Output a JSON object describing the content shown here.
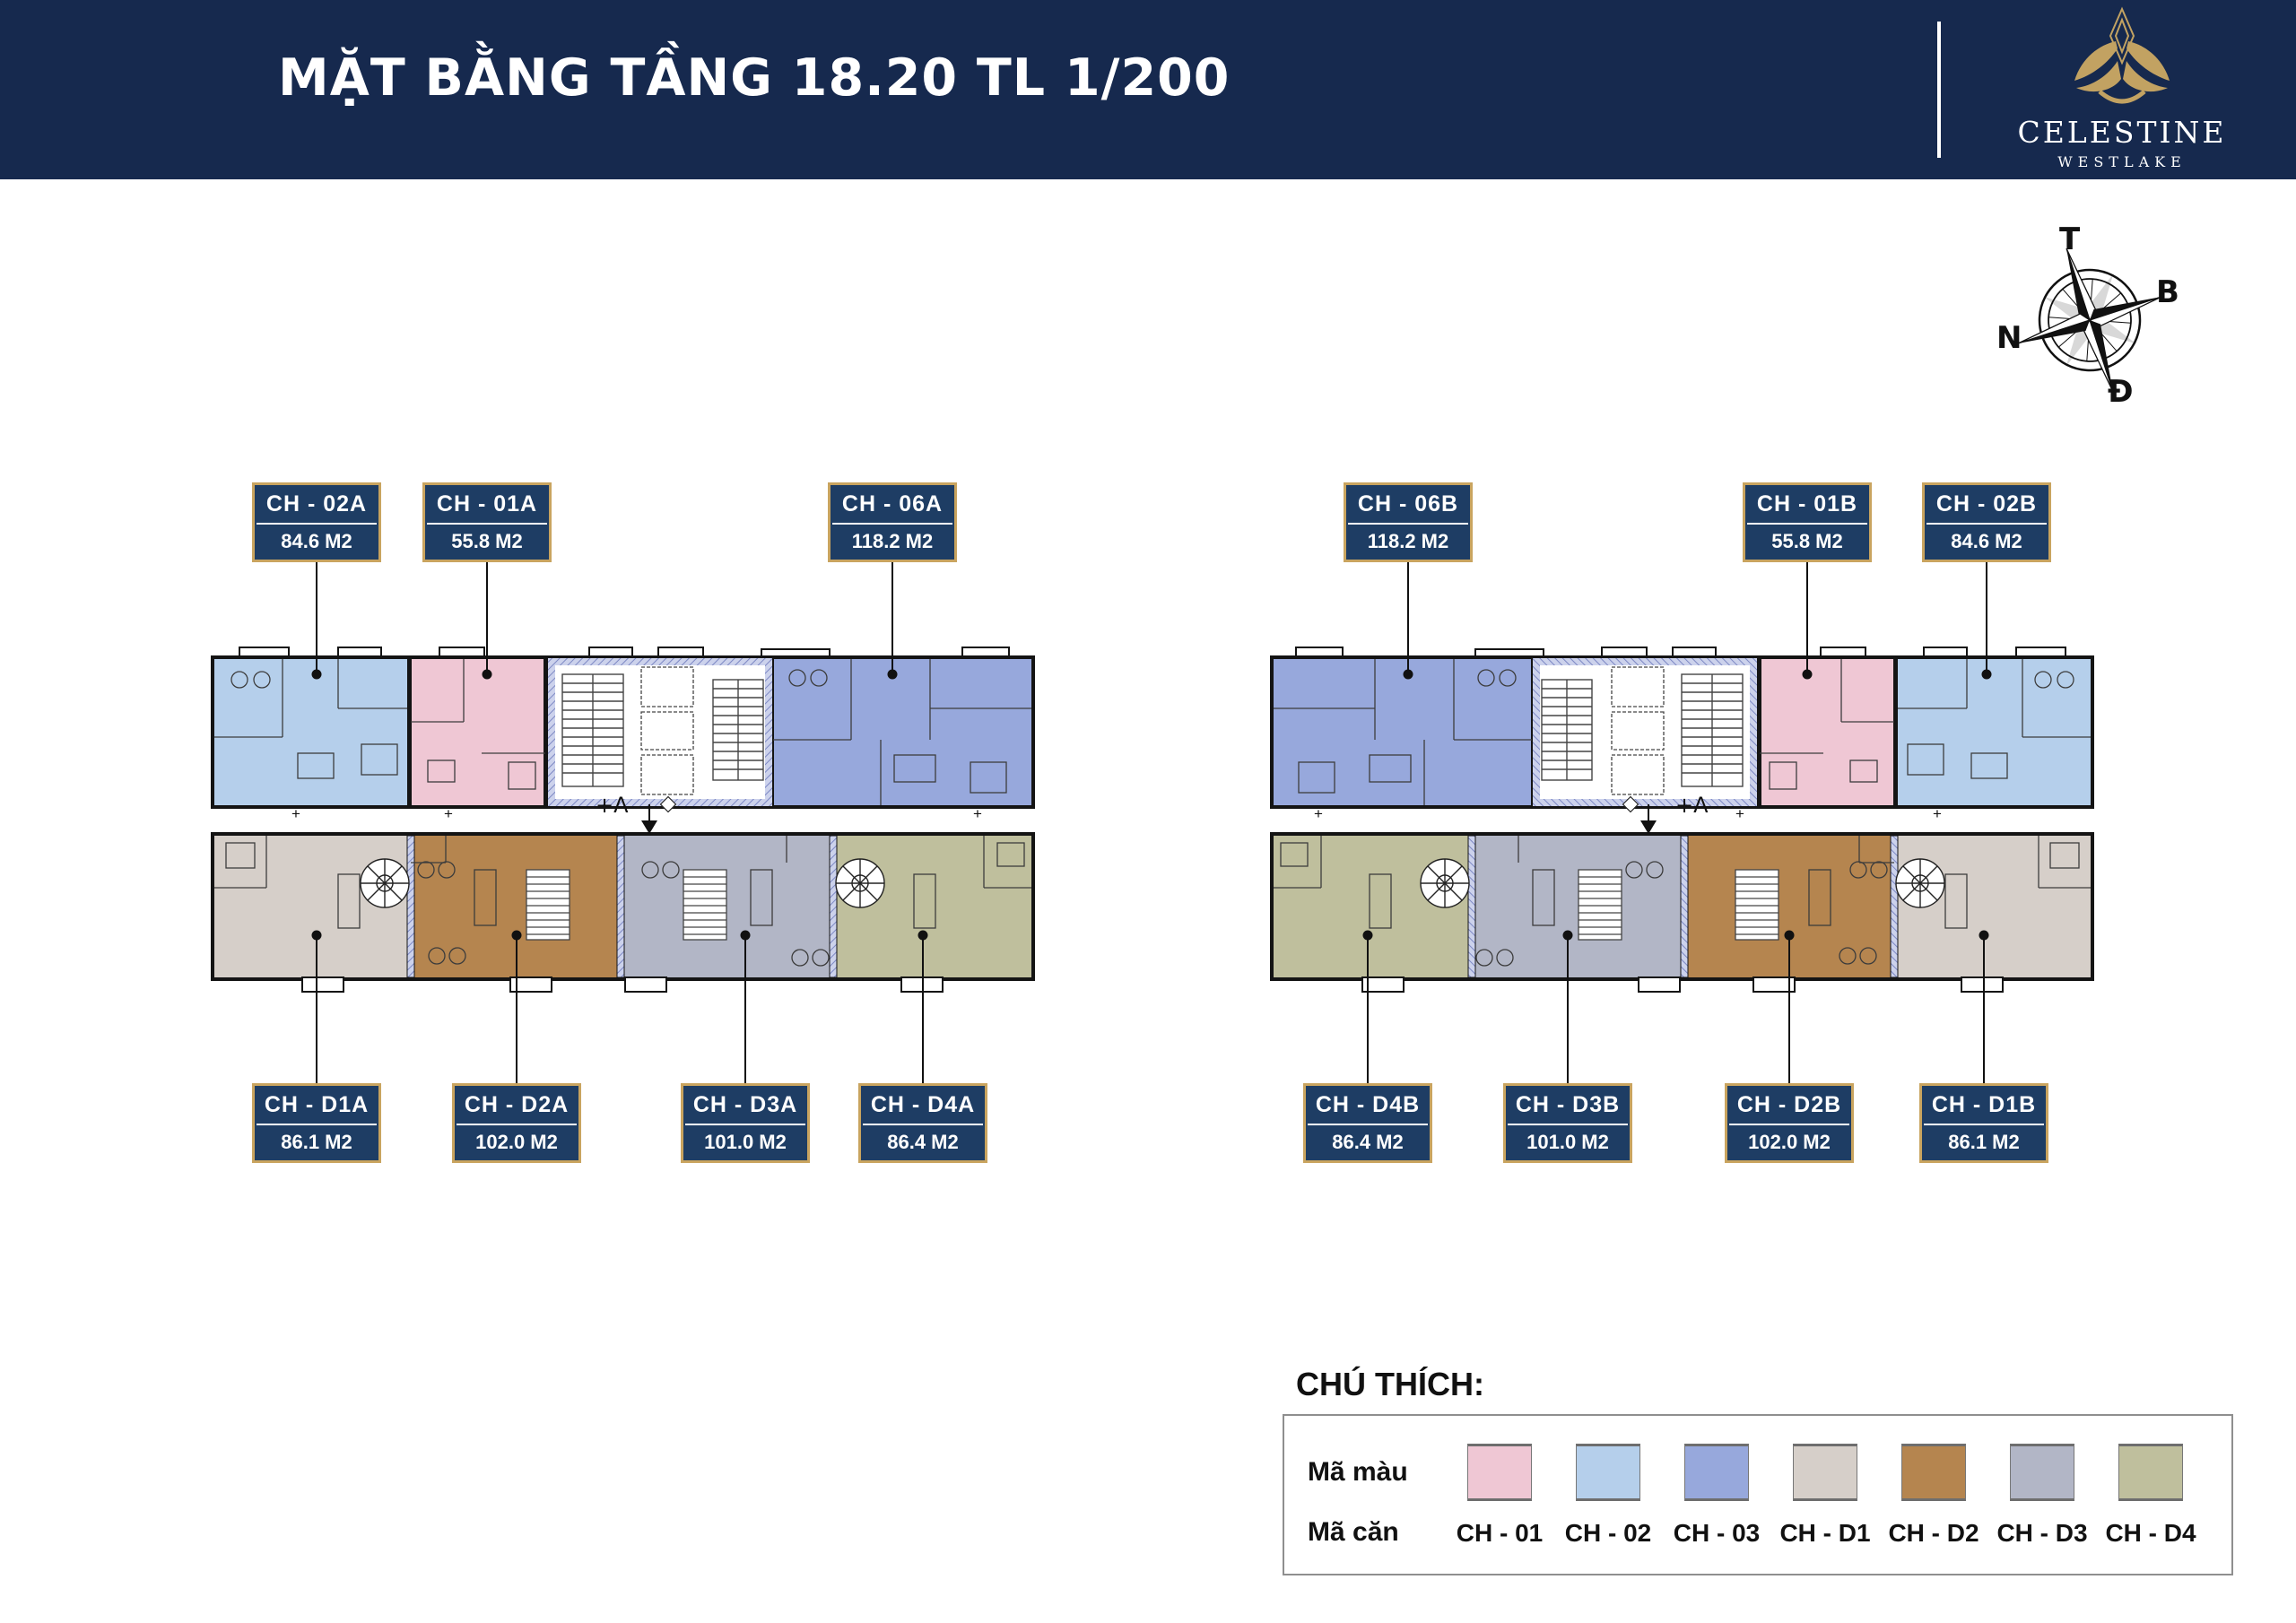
{
  "header": {
    "title": "MẶT BẰNG TẦNG 18.20 TL 1/200",
    "brand_name": "CELESTINE",
    "brand_sub": "WESTLAKE"
  },
  "compass": {
    "top": "T",
    "right": "B",
    "left": "N",
    "bottom": "Đ"
  },
  "colors": {
    "navy": "#16294e",
    "label_navy": "#1e3d64",
    "gold": "#c9a45f",
    "ch01": "#efc7d4",
    "ch02": "#b5cfeb",
    "ch03": "#97a8dc",
    "chd1": "#d6cfc9",
    "chd2": "#b5854f",
    "chd3": "#b2b6c6",
    "chd4": "#bfbf9d"
  },
  "annotations": {
    "level_mark": "+A",
    "plus_mark": "+"
  },
  "labels_top": [
    {
      "code": "CH - 02A",
      "area": "84.6 M2"
    },
    {
      "code": "CH - 01A",
      "area": "55.8 M2"
    },
    {
      "code": "CH - 06A",
      "area": "118.2 M2"
    },
    {
      "code": "CH - 06B",
      "area": "118.2 M2"
    },
    {
      "code": "CH - 01B",
      "area": "55.8 M2"
    },
    {
      "code": "CH - 02B",
      "area": "84.6 M2"
    }
  ],
  "labels_bottom": [
    {
      "code": "CH - D1A",
      "area": "86.1 M2"
    },
    {
      "code": "CH - D2A",
      "area": "102.0 M2"
    },
    {
      "code": "CH - D3A",
      "area": "101.0 M2"
    },
    {
      "code": "CH - D4A",
      "area": "86.4 M2"
    },
    {
      "code": "CH - D4B",
      "area": "86.4 M2"
    },
    {
      "code": "CH - D3B",
      "area": "101.0 M2"
    },
    {
      "code": "CH - D2B",
      "area": "102.0 M2"
    },
    {
      "code": "CH - D1B",
      "area": "86.1 M2"
    }
  ],
  "legend": {
    "heading": "CHÚ THÍCH:",
    "color_row_label": "Mã màu",
    "unit_row_label": "Mã căn",
    "entries": [
      {
        "code": "CH - 01",
        "color": "#efc7d4"
      },
      {
        "code": "CH - 02",
        "color": "#b5cfeb"
      },
      {
        "code": "CH - 03",
        "color": "#97a8dc"
      },
      {
        "code": "CH - D1",
        "color": "#d6cfc9"
      },
      {
        "code": "CH - D2",
        "color": "#b5854f"
      },
      {
        "code": "CH - D3",
        "color": "#b2b6c6"
      },
      {
        "code": "CH - D4",
        "color": "#bfbf9d"
      }
    ]
  }
}
